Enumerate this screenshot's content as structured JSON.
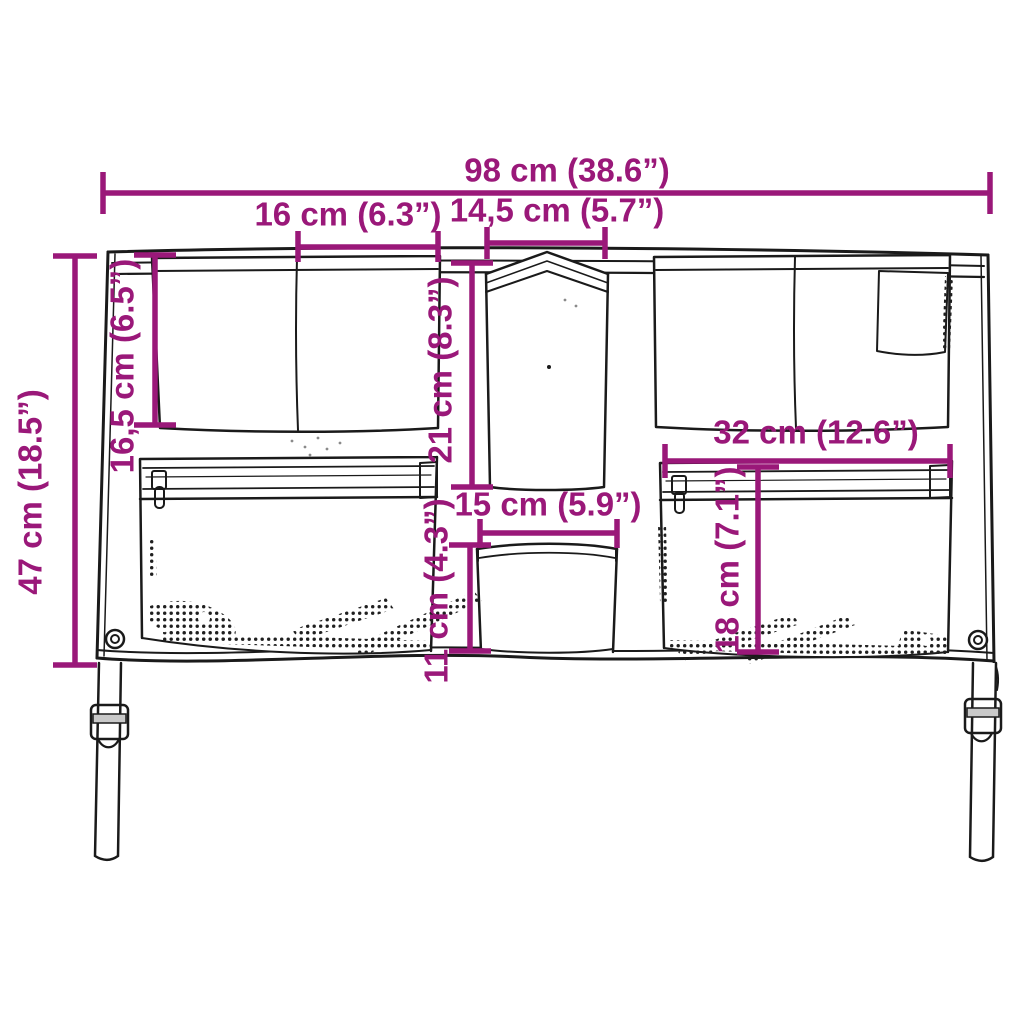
{
  "colors": {
    "dimension_accent": "#9A1879",
    "line_art": "#1A1A1A",
    "background": "#FFFFFF",
    "buckle_bar": "#C9C9C9"
  },
  "dimensions": {
    "overall_width": {
      "label": "98 cm (38.6”)",
      "cm": 98,
      "inches": 38.6,
      "orientation": "horizontal"
    },
    "left_top_pocket_width": {
      "label": "16 cm (6.3”)",
      "cm": 16,
      "inches": 6.3,
      "orientation": "horizontal"
    },
    "center_top_pocket_width": {
      "label": "14,5 cm (5.7”)",
      "cm": 14.5,
      "inches": 5.7,
      "orientation": "horizontal"
    },
    "overall_height": {
      "label": "47 cm (18.5”)",
      "cm": 47,
      "inches": 18.5,
      "orientation": "vertical"
    },
    "left_top_pocket_height": {
      "label": "16,5 cm (6.5”)",
      "cm": 16.5,
      "inches": 6.5,
      "orientation": "vertical"
    },
    "center_top_pocket_height": {
      "label": "21 cm (8.3”)",
      "cm": 21,
      "inches": 8.3,
      "orientation": "vertical"
    },
    "center_bottom_pocket_width": {
      "label": "15 cm (5.9”)",
      "cm": 15,
      "inches": 5.9,
      "orientation": "horizontal"
    },
    "center_bottom_pocket_height": {
      "label": "11 cm (4.3”)",
      "cm": 11,
      "inches": 4.3,
      "orientation": "vertical"
    },
    "right_pocket_width": {
      "label": "32 cm (12.6”)",
      "cm": 32,
      "inches": 12.6,
      "orientation": "horizontal"
    },
    "right_pocket_height": {
      "label": "18 cm (7.1”)",
      "cm": 18,
      "inches": 7.1,
      "orientation": "vertical"
    }
  }
}
